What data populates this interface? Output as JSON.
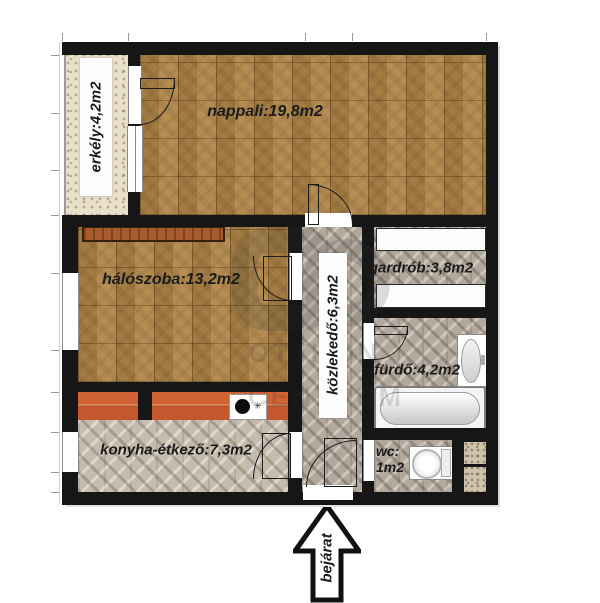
{
  "plan": {
    "rooms": {
      "nappali": {
        "label": "nappali:19,8m2"
      },
      "erkely": {
        "label": "erkély:4,2m2"
      },
      "haloszoba": {
        "label": "hálószoba:13,2m2"
      },
      "gardrob": {
        "label": "gardrób:3,8m2"
      },
      "kozlekedo": {
        "label": "közlekedő:6,3m2"
      },
      "furdo": {
        "label": "fürdő:4,2m2"
      },
      "konyha": {
        "label": "konyha-étkező:7,3m2"
      },
      "wc": {
        "label_line1": "wc:",
        "label_line2": "1m2"
      }
    },
    "entrance": {
      "label": "bejárat"
    },
    "watermark": {
      "line1": "OTTHON",
      "line2": "CENTRUM"
    },
    "colors": {
      "wall": "#161616",
      "wood_floor": "#b1874a",
      "grey_tile": "#b2a89c",
      "kitchen_counter": "#c4572c",
      "balcony_stone": "#e9e0cc"
    }
  }
}
